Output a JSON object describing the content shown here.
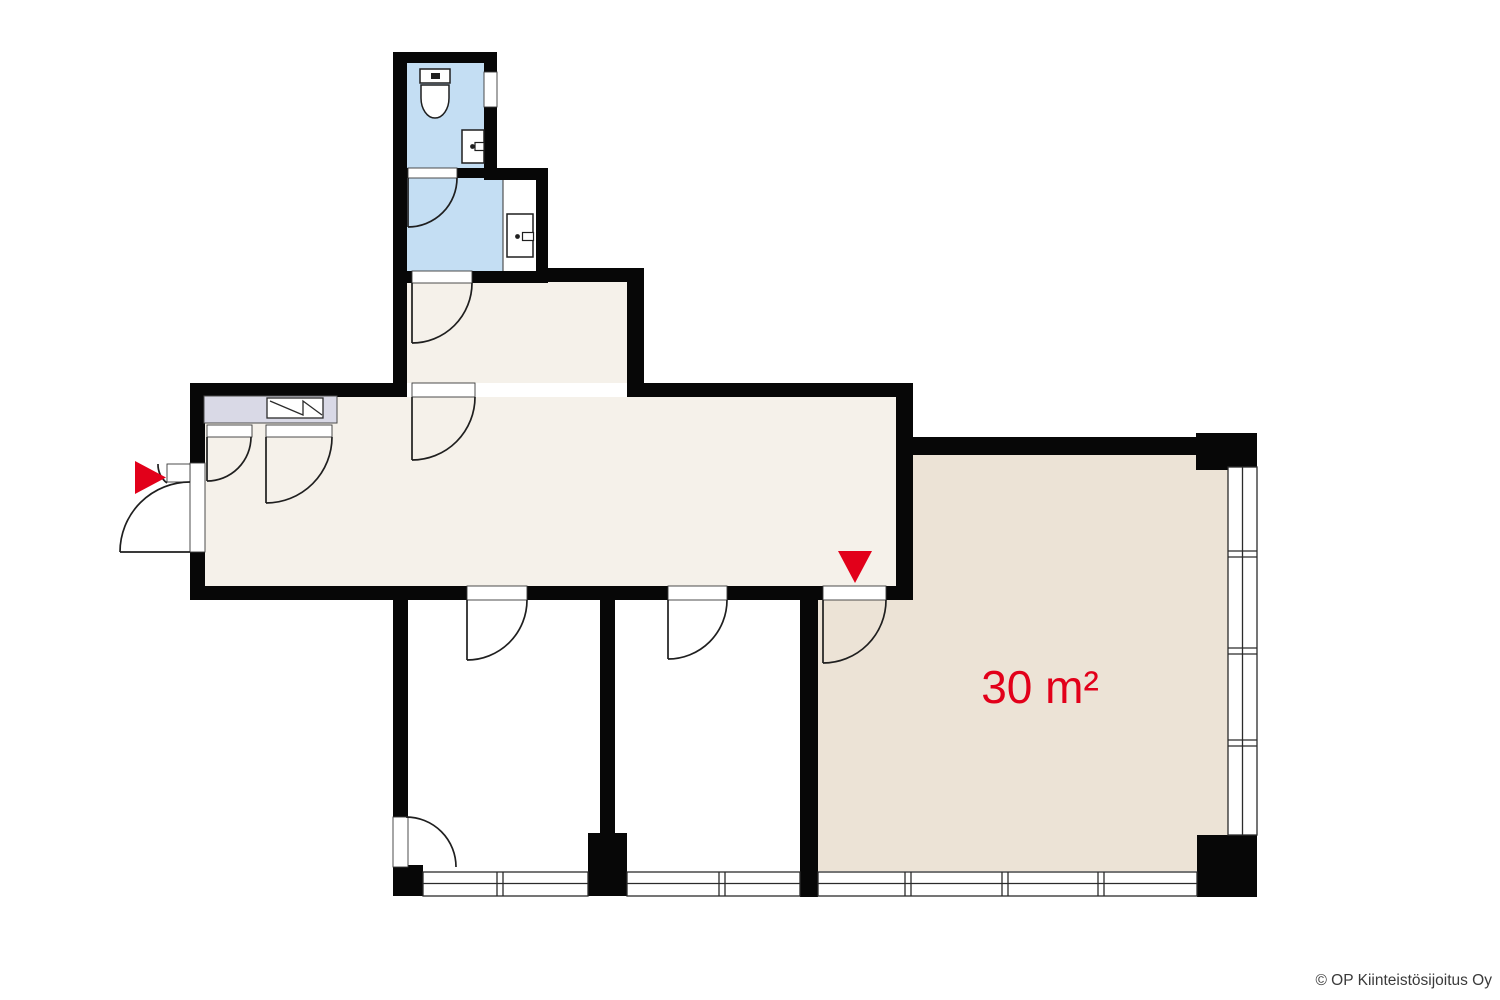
{
  "image": {
    "type": "apartment-floor-plan",
    "area_label": "30 m²",
    "copyright": "© OP Kiinteistösijoitus Oy",
    "colors": {
      "background": "#ffffff",
      "wall": "#070707",
      "hallway_floor": "#f5f1ea",
      "room_floor": "#ffffff",
      "large_room_floor": "#ece3d6",
      "bathroom_floor": "#c4def3",
      "closet_fill": "#d9d9e6",
      "accent_red": "#e2001a",
      "line": "#1f1f1f",
      "copyright_color": "#3a3a3a"
    },
    "icons": {
      "entrance_marker": "red-right-triangle",
      "room_entry_marker": "red-down-triangle",
      "toilet": "toilet-plan-icon",
      "sink": "sink-plan-icon",
      "wardrobe_symbol": "zigzag-box-icon"
    }
  }
}
